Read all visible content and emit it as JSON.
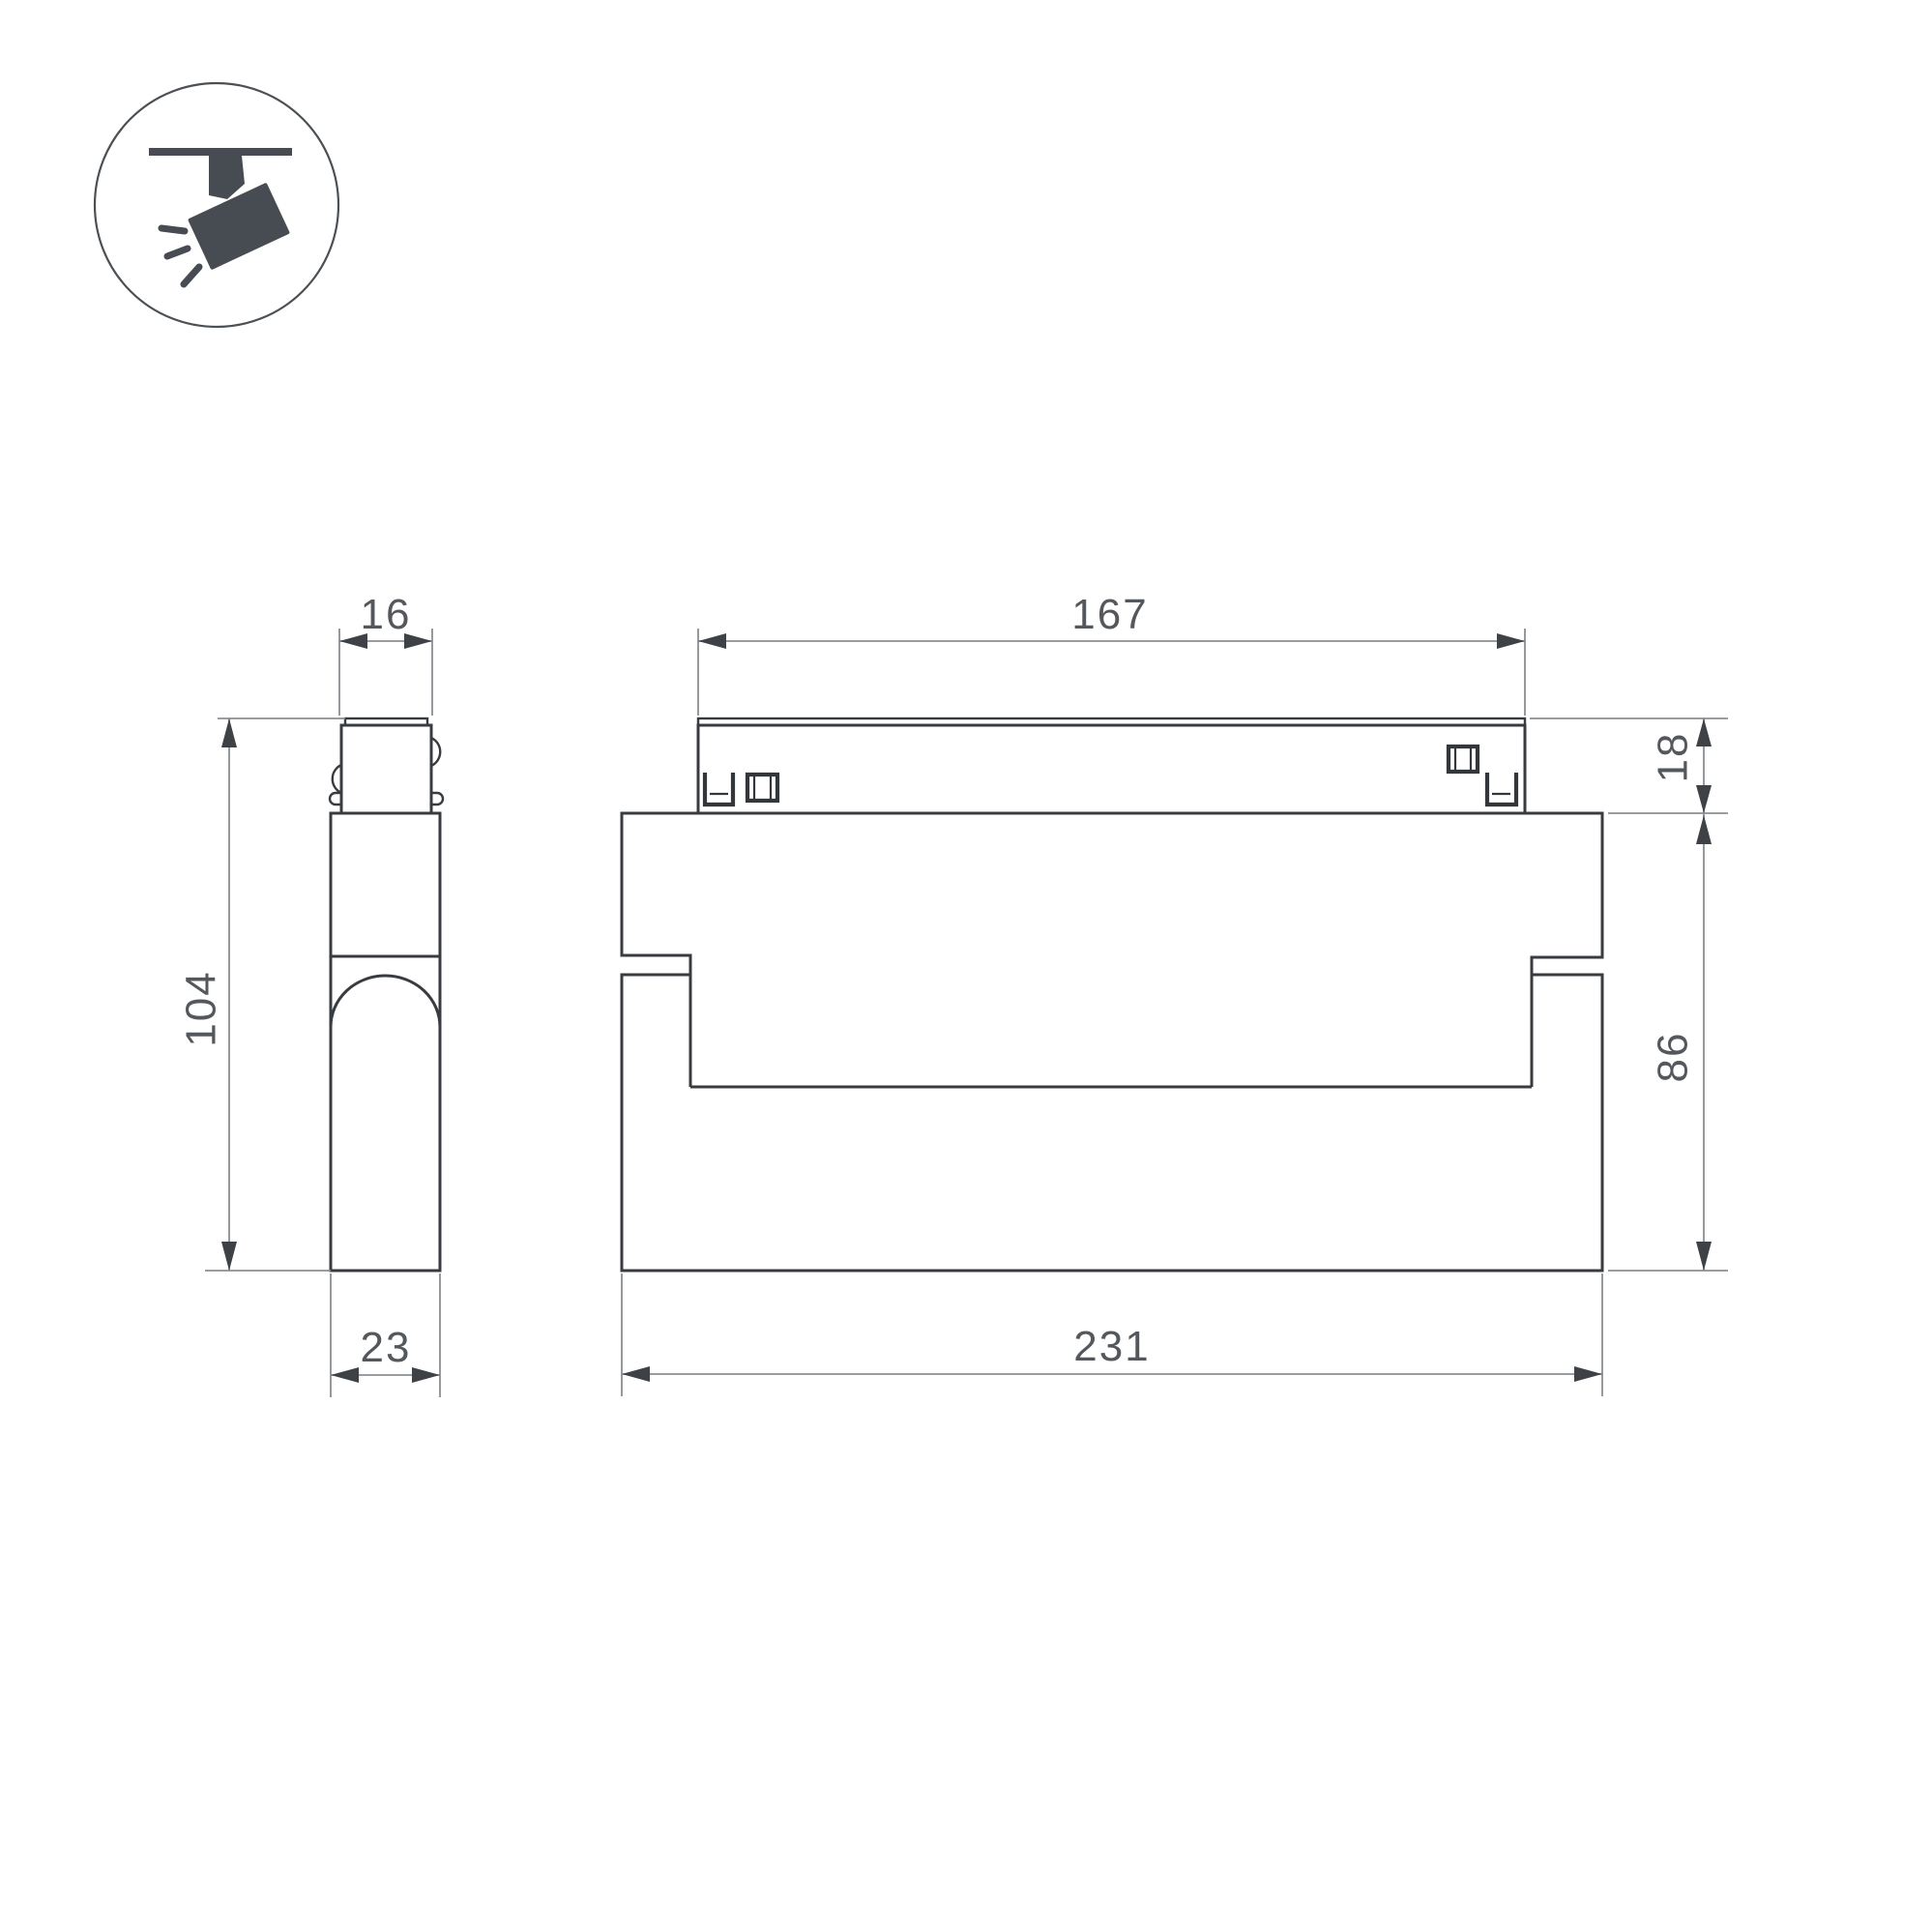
{
  "drawing": {
    "kind": "technical-dimension-drawing",
    "background_color": "#ffffff",
    "object_line_color": "#383c40",
    "dimension_line_color": "#8b8f93",
    "dimension_text_color": "#54585c",
    "icon": {
      "name": "ceiling-track-spotlight-icon",
      "color": "#474c52",
      "description": "circle badge with track-mounted tilted spotlight emitting light rays"
    },
    "views": {
      "side_view": {
        "name": "side view",
        "dimensions_mm": {
          "track_adapter_width": "16",
          "overall_height": "104",
          "body_depth": "23"
        }
      },
      "front_view": {
        "name": "front view",
        "dimensions_mm": {
          "track_adapter_length": "167",
          "track_adapter_height": "18",
          "body_height": "86",
          "body_length": "231"
        }
      }
    }
  }
}
